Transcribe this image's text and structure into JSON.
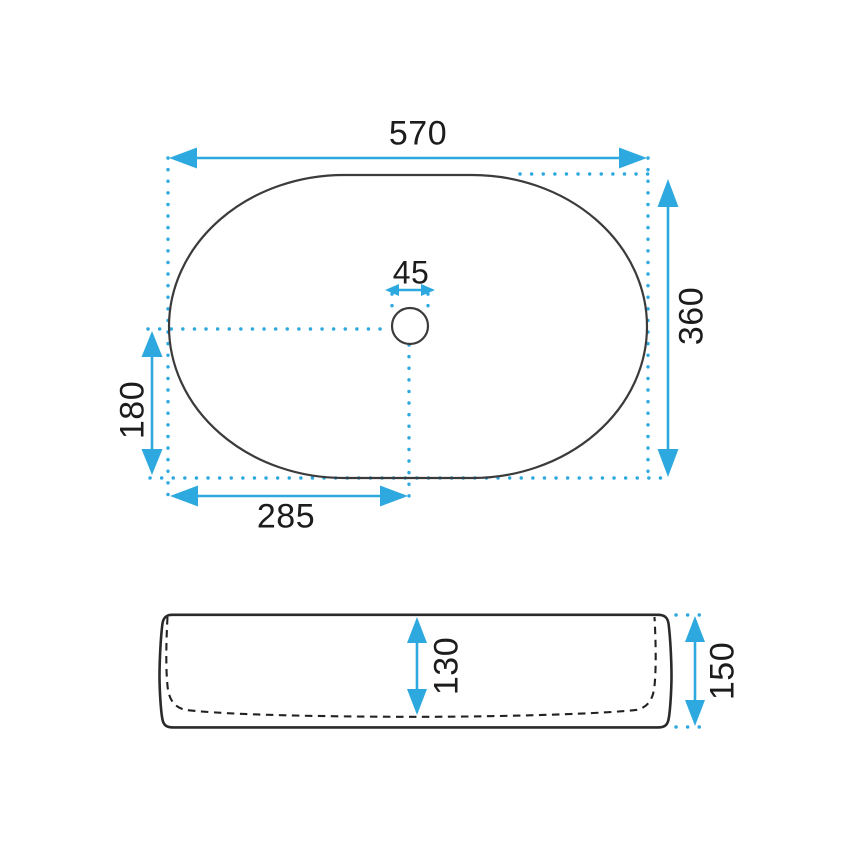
{
  "title": "washbasin-dimension-drawing",
  "colors": {
    "accent": "#2EA9DF",
    "outline": "#3B3B3B",
    "dash": "#222222",
    "text": "#1C1C1C"
  },
  "dims": {
    "top_width": "570",
    "top_depth": "360",
    "drain_diameter": "45",
    "drain_offset_depth": "180",
    "drain_offset_width": "285",
    "side_inner_height": "130",
    "side_outer_height": "150"
  }
}
